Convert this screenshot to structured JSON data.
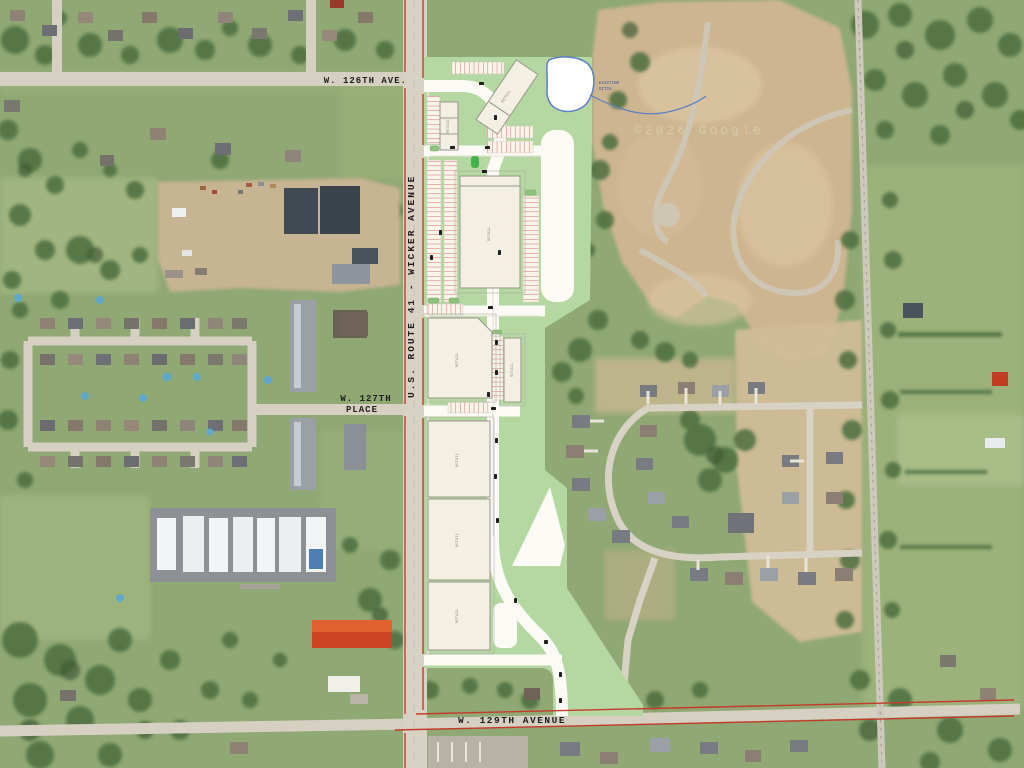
{
  "title": "Aerial site plan - U.S. Route 41 retail development",
  "street_labels": {
    "route41": "U.S. ROUTE 41 - WICKER AVENUE",
    "ave126": "W. 126TH AVE.",
    "place127_l1": "W. 127TH",
    "place127_l2": "PLACE",
    "ave129": "W. 129TH AVENUE"
  },
  "annotations": {
    "watermark": "©2026 Google",
    "pond_note_l1": "EXISTING",
    "pond_note_l2": "DITCH"
  },
  "site_plan": {
    "overlay_color": "#b5d8a3",
    "pad_fill": "#f3efe2",
    "stall_color": "#d4685c",
    "road_edge_color": "#c43b2c",
    "pond_outline": "#5b7fc4",
    "drive_color": "#fbfaf5",
    "buildings": [
      {
        "id": "shops-north",
        "label": "RETAIL"
      },
      {
        "id": "angled-shops",
        "label": "RETAIL"
      },
      {
        "id": "anchor-retail",
        "label": "RETAIL"
      },
      {
        "id": "midbox-west",
        "label": "RETAIL"
      },
      {
        "id": "midbox-east",
        "label": "RETAIL"
      },
      {
        "id": "south-pad-1",
        "label": "RETAIL"
      },
      {
        "id": "south-pad-2",
        "label": "RETAIL"
      },
      {
        "id": "south-pad-3",
        "label": "RETAIL"
      }
    ]
  }
}
